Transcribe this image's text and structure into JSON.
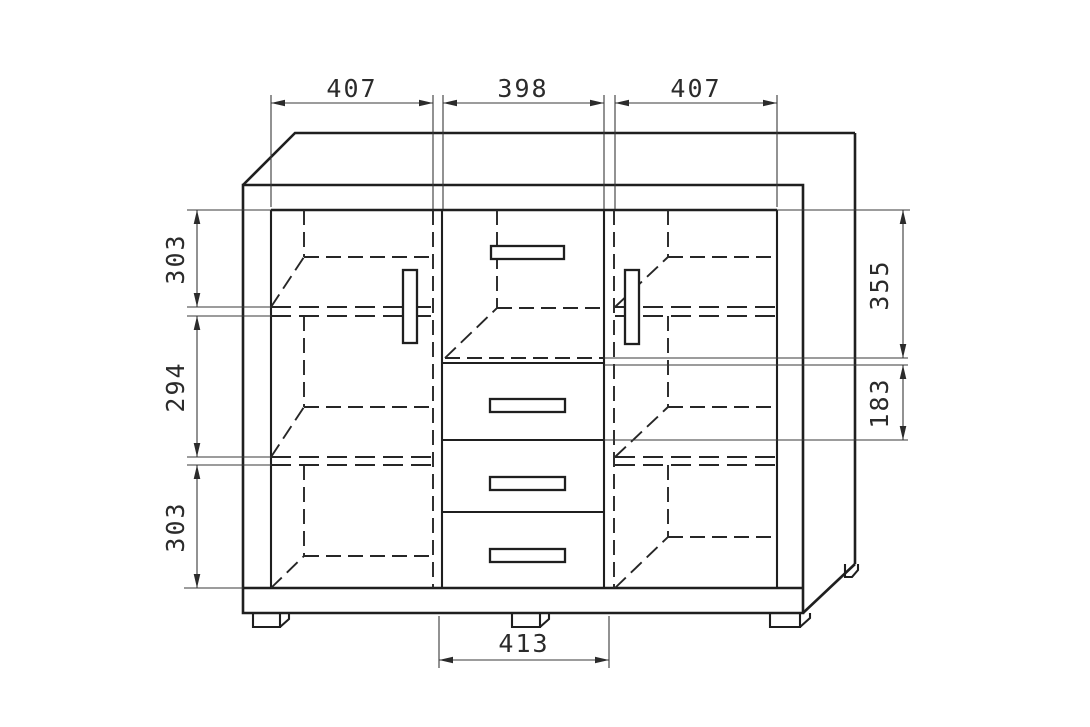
{
  "diagram": {
    "kind": "furniture-dimension-drawing",
    "dimensions": {
      "top": [
        "407",
        "398",
        "407"
      ],
      "left": [
        "303",
        "294",
        "303"
      ],
      "right": [
        "355",
        "183"
      ],
      "bottom": [
        "413"
      ]
    },
    "colors": {
      "line": "#1f1f1f",
      "background": "#ffffff",
      "dimension_text": "#2b2b2b"
    }
  }
}
